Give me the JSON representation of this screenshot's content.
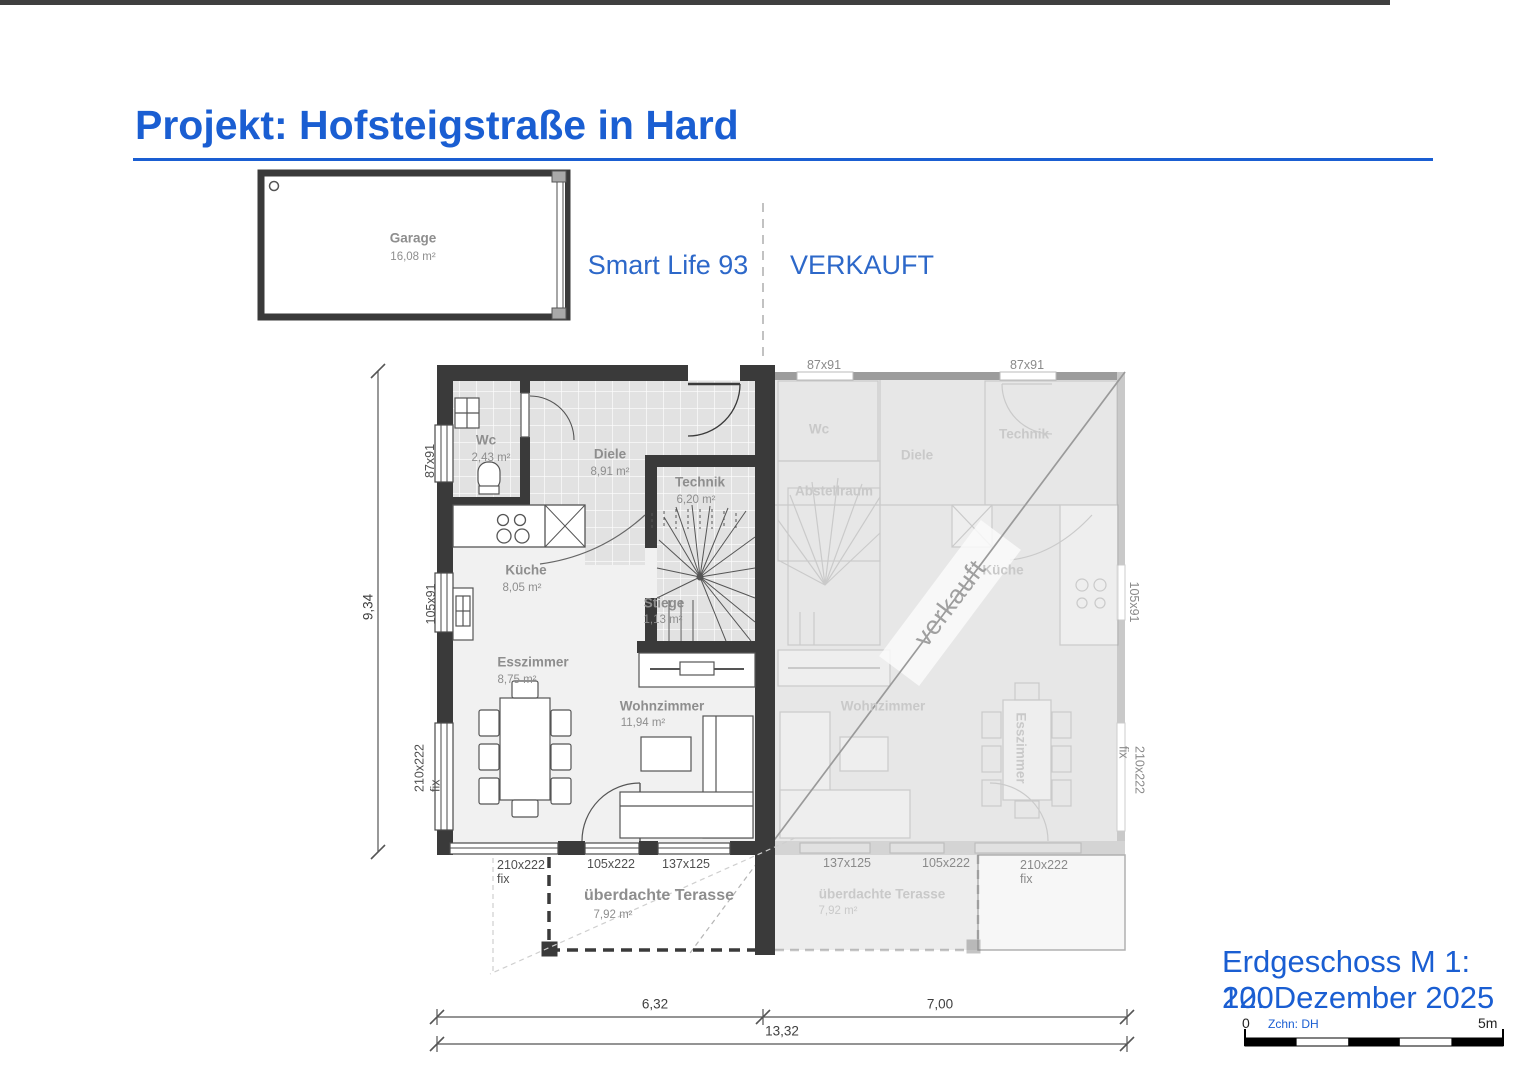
{
  "colors": {
    "accent": "#1a5ed2",
    "wall": "#3a3a3a"
  },
  "header": {
    "title": "Projekt: Hofsteigstraße in Hard"
  },
  "unit": {
    "name": "Smart Life 93",
    "status": "VERKAUFT",
    "watermark": "verkauft"
  },
  "garage": {
    "name": "Garage",
    "area": "16,08 m²"
  },
  "rooms": {
    "wc": {
      "name": "Wc",
      "area": "2,43 m²"
    },
    "diele": {
      "name": "Diele",
      "area": "8,91 m²"
    },
    "technik": {
      "name": "Technik",
      "area": "6,20 m²"
    },
    "kueche": {
      "name": "Küche",
      "area": "8,05 m²"
    },
    "stiege": {
      "name": "Stiege",
      "area": "1,13 m²"
    },
    "esszimmer": {
      "name": "Esszimmer",
      "area": "8,75 m²"
    },
    "wohnzimmer": {
      "name": "Wohnzimmer",
      "area": "11,94 m²"
    },
    "terrasse": {
      "name": "überdachte Terasse",
      "area": "7,92 m²"
    }
  },
  "mirror": {
    "abstellraum": "Abstellraum"
  },
  "dims": {
    "height_total": "9,34",
    "width_left": "6,32",
    "width_right": "7,00",
    "width_total": "13,32",
    "win_87x91": "87x91",
    "win_105x91": "105x91",
    "win_105x222": "105x222",
    "win_137x125": "137x125",
    "win_210x222": "210x222",
    "fix": "fix"
  },
  "footer": {
    "plan_scale": "Erdgeschoss M 1: 100",
    "date": "22. Dezember 2025",
    "scale_zero": "0",
    "drawn_by": "Zchn: DH",
    "scale_end": "5m"
  }
}
